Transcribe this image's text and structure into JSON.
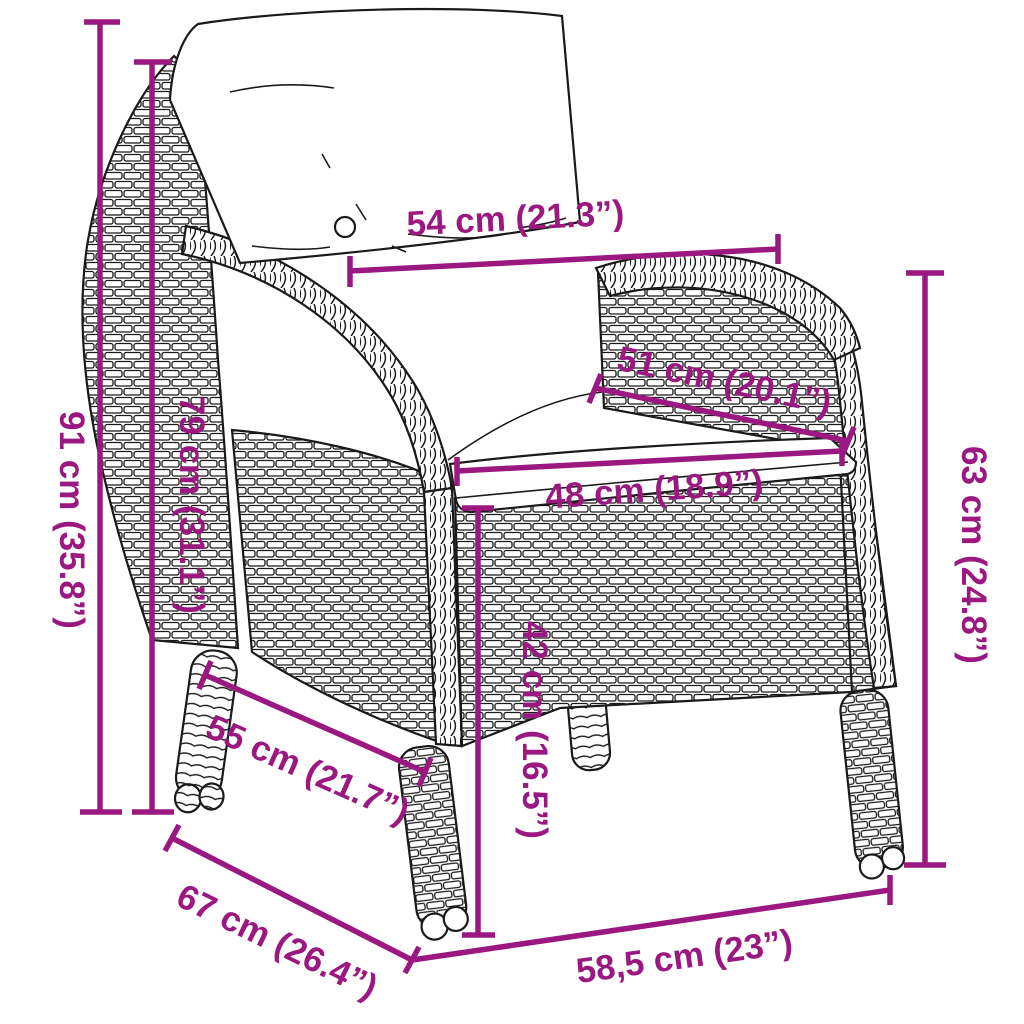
{
  "diagram": {
    "kind": "product-dimension-diagram",
    "subject": "rattan garden armchair with back and seat cushions",
    "accent_color": "#9B1880",
    "outline_color": "#1a1a1a",
    "background_color": "#ffffff",
    "unit_system": "cm with inch equivalents"
  },
  "dimensions": {
    "height_total": "91 cm (35.8”)",
    "backrest_height": "79 cm (31.1”)",
    "back_width": "54 cm (21.3”)",
    "seat_depth": "51 cm (20.1”)",
    "seat_width": "48 cm (18.9”)",
    "armrest_height": "63 cm (24.8”)",
    "seat_height": "42 cm (16.5”)",
    "inner_depth": "55 cm (21.7”)",
    "total_depth": "67 cm (26.4”)",
    "front_width": "58,5 cm (23”)"
  }
}
